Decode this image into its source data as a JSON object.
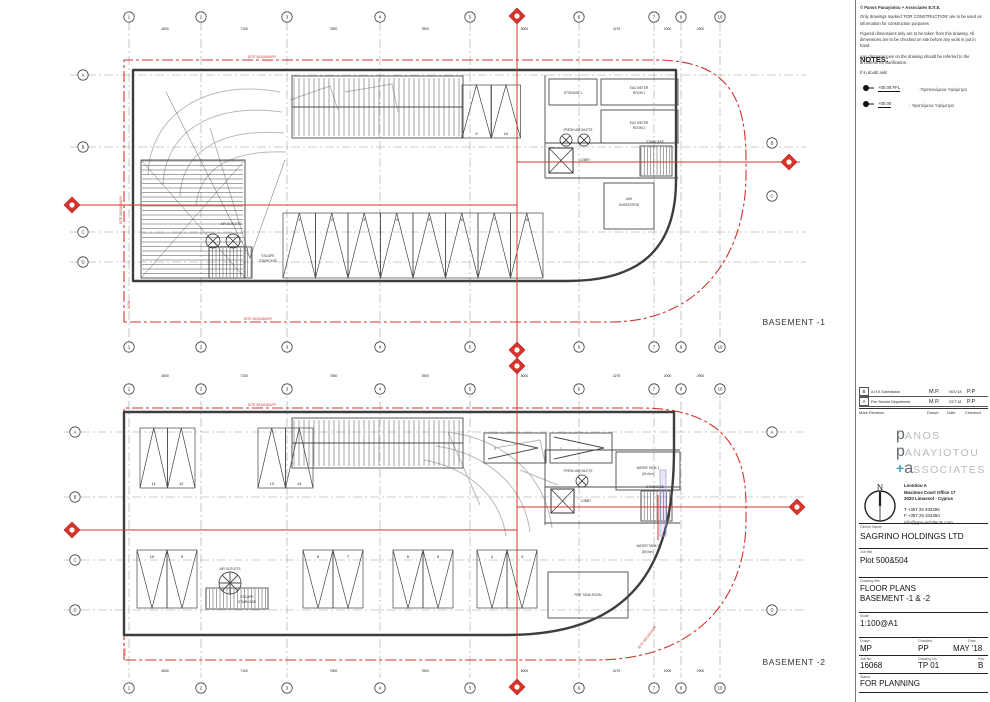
{
  "disclaimer": {
    "copyright": "© Panos Panayiotou + Associates Ε.Π.Ε.",
    "line1": "Only drawings marked 'FOR CONSTRUCTION' are to be used as information for construction purposes",
    "line2": "Figured dimensions only are to be taken from this drawing. All dimensions are to be checked on site before any work is put in hand.",
    "line3": "Any discrepancies on the drawing should be referred to the architects for clarification.",
    "line4": "If in doubt ask!"
  },
  "notes": {
    "title": "NOTES:",
    "note1_level": "+00.00 FFL",
    "note1_text": ": Προτεινόμενα Υψόμετρα",
    "note2_level": "+00.00",
    "note2_text": ": Υφιστάμενα Υψόμετρα"
  },
  "revision_table": {
    "rows": [
      {
        "mark": "B",
        "revision": "A.H.K Submission",
        "drawn": "M.P.",
        "date": "NOV'18",
        "checked": "P.P"
      },
      {
        "mark": "A",
        "revision": "Fire Service Department",
        "drawn": "M.P.",
        "date": "OCT'18",
        "checked": "P.P"
      }
    ],
    "headers": {
      "mark": "Mark",
      "revision": "Revision",
      "drawn": "Drawn",
      "date": "Date",
      "checked": "Checked"
    }
  },
  "logo": {
    "line1_initial": "p",
    "line1_rest": "ANOS",
    "line2_initial": "p",
    "line2_rest": "ANAYIOTOU",
    "line3_plus": "+",
    "line3_initial": "a",
    "line3_rest": "SSOCIATES"
  },
  "north_label": "N",
  "address": {
    "line1": "Leontiou A",
    "line2": "Maximos Court Office 17",
    "line3": "3020 Limassol - Cyprus",
    "tel": "T  +357 25 333286",
    "fax": "F  +357 25 333450",
    "email": "info@ppa-architects.com"
  },
  "titleblock": {
    "client_label": "Clients Name",
    "client": "SAGRINO HOLDINGS LTD",
    "job_label": "Job title",
    "job": "Plot 500&504",
    "drawing_label": "Drawing title",
    "drawing_line1": "FLOOR PLANS",
    "drawing_line2": "BASEMENT -1 &  -2",
    "scale_label": "Scale",
    "scale": "1:100@A1",
    "drawn_label": "Drawn",
    "drawn": "MP",
    "checked_label": "Checked",
    "checked": "PP",
    "date_label": "Date",
    "date": "MAY '18",
    "jobno_label": "Job No",
    "jobno": "16068",
    "dwgno_label": "Drawing No",
    "dwgno": "TP 01",
    "rev_label": "Rev",
    "rev": "B",
    "status_label": "Status",
    "status": "FOR PLANNING"
  },
  "plans": {
    "dims": [
      "4500",
      "7100",
      "7800",
      "7800",
      "8000",
      "4275",
      "2000",
      "2900"
    ],
    "b1": {
      "name": "BASEMENT -1",
      "grid_cols": [
        "1",
        "2",
        "3",
        "4",
        "5",
        "6",
        "7",
        "9",
        "10"
      ],
      "rows_left": [
        "A",
        "B",
        "C",
        "D"
      ],
      "rows_right": [
        "B",
        "C"
      ],
      "stalls": [
        "1",
        "2",
        "3",
        "4",
        "5",
        "6",
        "7",
        "8",
        "9",
        "10"
      ],
      "labels": {
        "storage": "STORAGE 1",
        "eac1a": "EAC METER",
        "eac1b": "ROOM 1",
        "eac2a": "EAC METER",
        "eac2b": "ROOM 2",
        "fresh": "FRESH AIR INLETS",
        "lobby": "LOBBY",
        "stair": "STAIRCASE",
        "ahk1": "AHK",
        "ahk2": "SUBSTATION",
        "air": "AIR OUTLETS",
        "esc1": "ESCAPE",
        "esc2": "STAIRCASE"
      },
      "boundary_label": "SITE BOUNDARY",
      "offset_dim": "3150"
    },
    "b2": {
      "name": "BASEMENT -2",
      "grid_cols": [
        "1",
        "2",
        "3",
        "4",
        "5",
        "6",
        "7",
        "9",
        "10"
      ],
      "rows_left": [
        "A",
        "B",
        "C",
        "D"
      ],
      "rows_right": [
        "A",
        "D"
      ],
      "stalls": [
        "11",
        "12",
        "13",
        "14",
        "10",
        "9",
        "8",
        "7",
        "6",
        "5",
        "4",
        "3"
      ],
      "stalls_side": [
        "2",
        "1"
      ],
      "labels": {
        "fresh": "FRESH AIR INLETS",
        "wt1a": "WATER TANK 1",
        "wt1b": "(50.0m³)",
        "wt2a": "WATER TANK 2",
        "wt2b": "(50.0m³)",
        "lobby": "LOBBY",
        "stair": "STAIRCASE",
        "esc1": "ESCAPE",
        "esc2": "STAIRCASE",
        "fire": "FIRE TANK ROOM",
        "air": "AIR OUTLETS"
      },
      "boundary_label": "SITE BOUNDARY",
      "offset_dim": "3150"
    }
  }
}
